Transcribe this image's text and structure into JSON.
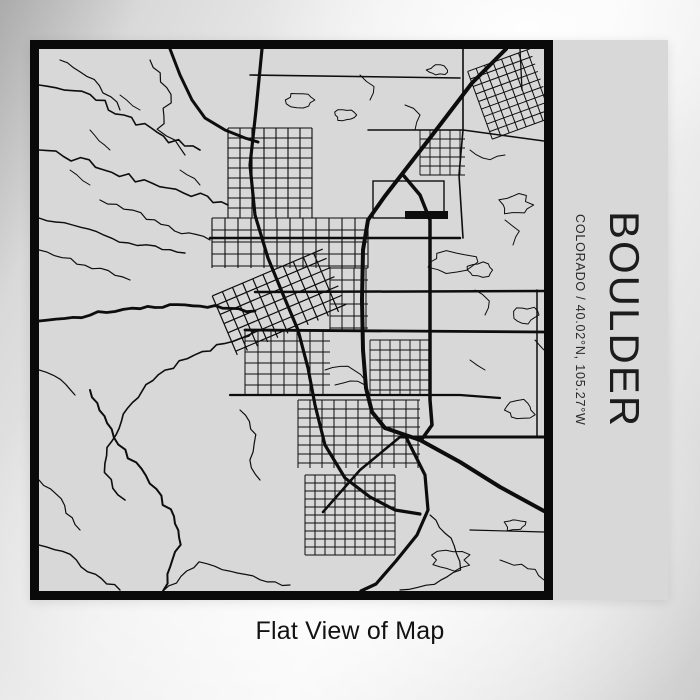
{
  "product": {
    "title": "BOULDER",
    "subtitle": "COLORADO / 40.02°N, 105.27°W",
    "caption": "Flat View of Map"
  },
  "colors": {
    "paper": "#d8d8d8",
    "ink": "#0d0d0d",
    "frame": "#0a0a0a",
    "title_text": "#1c1c1c",
    "caption_text": "#121212"
  },
  "map_art": {
    "viewbox": [
      0,
      0,
      505,
      542
    ],
    "roads": [
      {
        "w": 4,
        "pts": [
          [
            467,
            0
          ],
          [
            433,
            34
          ],
          [
            391,
            89
          ],
          [
            346,
            147
          ],
          [
            329,
            171
          ],
          [
            324,
            201
          ],
          [
            323,
            251
          ],
          [
            324,
            301
          ],
          [
            327,
            339
          ],
          [
            333,
            363
          ],
          [
            346,
            379
          ]
        ]
      },
      {
        "w": 4,
        "pts": [
          [
            346,
            379
          ],
          [
            381,
            391
          ],
          [
            421,
            413
          ],
          [
            461,
            438
          ],
          [
            505,
            462
          ]
        ]
      },
      {
        "w": 3.2,
        "pts": [
          [
            366,
            386
          ],
          [
            386,
            426
          ],
          [
            389,
            461
          ],
          [
            378,
            486
          ],
          [
            357,
            512
          ],
          [
            337,
            535
          ],
          [
            322,
            542
          ]
        ]
      },
      {
        "w": 3.2,
        "pts": [
          [
            223,
            0
          ],
          [
            217,
            61
          ],
          [
            211,
            116
          ],
          [
            216,
            166
          ],
          [
            229,
            209
          ],
          [
            243,
            243
          ],
          [
            259,
            281
          ],
          [
            269,
            319
          ],
          [
            276,
            356
          ],
          [
            286,
            396
          ],
          [
            306,
            429
          ],
          [
            331,
            448
          ],
          [
            356,
            461
          ],
          [
            381,
            465
          ]
        ]
      },
      {
        "w": 2.5,
        "pts": [
          [
            284,
            463
          ],
          [
            321,
            421
          ],
          [
            361,
            388
          ]
        ]
      },
      {
        "w": 3,
        "pts": [
          [
            131,
            0
          ],
          [
            141,
            26
          ],
          [
            153,
            51
          ],
          [
            166,
            69
          ],
          [
            186,
            81
          ],
          [
            206,
            89
          ],
          [
            219,
            93
          ]
        ]
      },
      {
        "w": 3.5,
        "pts": [
          [
            365,
            127
          ],
          [
            381,
            146
          ],
          [
            391,
            171
          ],
          [
            391,
            250
          ],
          [
            391,
            311
          ],
          [
            391,
            351
          ],
          [
            393,
            376
          ],
          [
            383,
            390
          ]
        ]
      },
      {
        "w": 2.8,
        "pts": [
          [
            206,
            281
          ],
          [
            505,
            283
          ]
        ]
      },
      {
        "w": 2.5,
        "pts": [
          [
            216,
            243
          ],
          [
            505,
            242
          ]
        ]
      },
      {
        "w": 2.5,
        "pts": [
          [
            171,
            189
          ],
          [
            421,
            189
          ]
        ]
      },
      {
        "w": 3,
        "pts": [
          [
            361,
            388
          ],
          [
            505,
            388
          ]
        ]
      },
      {
        "w": 2.2,
        "pts": [
          [
            191,
            346
          ],
          [
            421,
            346
          ],
          [
            461,
            349
          ]
        ]
      },
      {
        "w": 2.8,
        "amp": 2.5,
        "seed": 11,
        "pts": [
          [
            0,
            272
          ],
          [
            51,
            266
          ],
          [
            101,
            258
          ],
          [
            146,
            257
          ],
          [
            191,
            259
          ],
          [
            216,
            262
          ]
        ]
      },
      {
        "w": 1.6,
        "amp": 3.5,
        "seed": 12,
        "pts": [
          [
            0,
            101
          ],
          [
            41,
            111
          ],
          [
            81,
            126
          ],
          [
            121,
            136
          ],
          [
            161,
            146
          ],
          [
            189,
            156
          ]
        ]
      },
      {
        "w": 1.4,
        "amp": 3,
        "seed": 13,
        "pts": [
          [
            0,
            169
          ],
          [
            41,
            181
          ],
          [
            81,
            191
          ],
          [
            116,
            199
          ],
          [
            146,
            204
          ]
        ]
      },
      {
        "w": 1.6,
        "amp": 3.5,
        "seed": 14,
        "pts": [
          [
            0,
            36
          ],
          [
            51,
            46
          ],
          [
            91,
            71
          ],
          [
            131,
            91
          ],
          [
            161,
            101
          ]
        ]
      },
      {
        "w": 1.2,
        "amp": 3,
        "seed": 15,
        "pts": [
          [
            21,
            11
          ],
          [
            61,
            36
          ],
          [
            81,
            61
          ]
        ]
      },
      {
        "w": 1.2,
        "amp": 3.5,
        "seed": 16,
        "pts": [
          [
            111,
            11
          ],
          [
            131,
            46
          ],
          [
            121,
            81
          ],
          [
            146,
            106
          ]
        ]
      },
      {
        "w": 1.2,
        "amp": 3,
        "seed": 17,
        "pts": [
          [
            61,
            151
          ],
          [
            101,
            166
          ],
          [
            136,
            181
          ],
          [
            171,
            191
          ]
        ]
      },
      {
        "w": 1.2,
        "amp": 3,
        "seed": 18,
        "pts": [
          [
            0,
            201
          ],
          [
            31,
            211
          ],
          [
            61,
            221
          ],
          [
            91,
            231
          ]
        ]
      },
      {
        "w": 1.6,
        "amp": 3,
        "seed": 19,
        "pts": [
          [
            216,
            281
          ],
          [
            186,
            296
          ],
          [
            156,
            306
          ],
          [
            126,
            321
          ],
          [
            101,
            341
          ],
          [
            86,
            366
          ],
          [
            71,
            391
          ],
          [
            64,
            414
          ],
          [
            71,
            431
          ],
          [
            86,
            451
          ]
        ]
      },
      {
        "w": 2,
        "amp": 3,
        "seed": 20,
        "pts": [
          [
            51,
            341
          ],
          [
            71,
            381
          ],
          [
            101,
            421
          ],
          [
            131,
            461
          ],
          [
            141,
            496
          ],
          [
            131,
            526
          ],
          [
            124,
            542
          ]
        ]
      },
      {
        "w": 1.4,
        "amp": 3,
        "seed": 21,
        "pts": [
          [
            0,
            496
          ],
          [
            31,
            506
          ],
          [
            56,
            526
          ],
          [
            81,
            541
          ]
        ]
      },
      {
        "w": 1.2,
        "amp": 3,
        "seed": 22,
        "pts": [
          [
            0,
            431
          ],
          [
            21,
            451
          ],
          [
            41,
            481
          ]
        ]
      },
      {
        "w": 1.2,
        "amp": 2.5,
        "seed": 23,
        "pts": [
          [
            201,
            361
          ],
          [
            216,
            386
          ],
          [
            211,
            411
          ],
          [
            221,
            431
          ]
        ]
      },
      {
        "w": 1.2,
        "amp": 2,
        "seed": 24,
        "pts": [
          [
            124,
            542
          ],
          [
            161,
            514
          ],
          [
            191,
            521
          ],
          [
            221,
            531
          ],
          [
            251,
            536
          ]
        ]
      },
      {
        "w": 1,
        "amp": 2,
        "seed": 25,
        "pts": [
          [
            51,
            81
          ],
          [
            71,
            101
          ]
        ]
      },
      {
        "w": 1,
        "amp": 2,
        "seed": 26,
        "pts": [
          [
            81,
            46
          ],
          [
            101,
            61
          ]
        ]
      },
      {
        "w": 1,
        "amp": 2,
        "seed": 27,
        "pts": [
          [
            141,
            121
          ],
          [
            161,
            136
          ]
        ]
      },
      {
        "w": 1,
        "amp": 2,
        "seed": 28,
        "pts": [
          [
            31,
            121
          ],
          [
            51,
            136
          ]
        ]
      },
      {
        "w": 1.2,
        "amp": 2,
        "seed": 29,
        "pts": [
          [
            0,
            321
          ],
          [
            21,
            331
          ],
          [
            36,
            346
          ]
        ]
      },
      {
        "w": 1.6,
        "pts": [
          [
            211,
            26
          ],
          [
            421,
            29
          ]
        ]
      },
      {
        "w": 1.6,
        "pts": [
          [
            424,
            0
          ],
          [
            424,
            81
          ],
          [
            420,
            126
          ],
          [
            424,
            189
          ]
        ]
      },
      {
        "w": 1.3,
        "pts": [
          [
            481,
            0
          ],
          [
            483,
            41
          ]
        ]
      },
      {
        "w": 1.5,
        "pts": [
          [
            329,
            81
          ],
          [
            424,
            81
          ],
          [
            505,
            92
          ]
        ]
      },
      {
        "w": 1,
        "amp": 2,
        "seed": 30,
        "pts": [
          [
            431,
            101
          ],
          [
            451,
            111
          ],
          [
            466,
            106
          ]
        ]
      },
      {
        "w": 1,
        "amp": 2,
        "seed": 31,
        "pts": [
          [
            466,
            171
          ],
          [
            481,
            181
          ],
          [
            474,
            196
          ]
        ]
      },
      {
        "w": 1,
        "amp": 2,
        "seed": 32,
        "pts": [
          [
            436,
            241
          ],
          [
            451,
            251
          ],
          [
            446,
            266
          ]
        ]
      },
      {
        "w": 1,
        "amp": 1.5,
        "seed": 33,
        "pts": [
          [
            496,
            291
          ],
          [
            505,
            301
          ]
        ]
      },
      {
        "w": 1,
        "amp": 1.5,
        "seed": 34,
        "pts": [
          [
            431,
            311
          ],
          [
            446,
            321
          ]
        ]
      },
      {
        "w": 1,
        "amp": 2,
        "seed": 35,
        "pts": [
          [
            366,
            56
          ],
          [
            381,
            66
          ],
          [
            376,
            81
          ]
        ]
      },
      {
        "w": 1,
        "amp": 2,
        "seed": 36,
        "pts": [
          [
            321,
            26
          ],
          [
            336,
            36
          ],
          [
            331,
            51
          ]
        ]
      },
      {
        "w": 1.5,
        "pts": [
          [
            498,
            241
          ],
          [
            498,
            388
          ]
        ]
      },
      {
        "w": 1.2,
        "pts": [
          [
            431,
            481
          ],
          [
            505,
            483
          ]
        ]
      },
      {
        "w": 1,
        "amp": 1.5,
        "seed": 37,
        "pts": [
          [
            286,
            321
          ],
          [
            301,
            316
          ],
          [
            316,
            321
          ],
          [
            326,
            331
          ]
        ]
      },
      {
        "w": 1,
        "amp": 1.5,
        "seed": 38,
        "pts": [
          [
            296,
            336
          ],
          [
            311,
            331
          ],
          [
            326,
            336
          ]
        ]
      },
      {
        "w": 1.2,
        "amp": 1.5,
        "seed": 39,
        "pts": [
          [
            391,
            466
          ],
          [
            416,
            496
          ],
          [
            421,
            521
          ],
          [
            396,
            536
          ],
          [
            361,
            541
          ]
        ]
      },
      {
        "w": 1,
        "amp": 2,
        "seed": 40,
        "pts": [
          [
            461,
            511
          ],
          [
            496,
            521
          ],
          [
            505,
            531
          ]
        ]
      }
    ],
    "grids": [
      {
        "x": 189,
        "y": 79,
        "w": 84,
        "h": 90,
        "dx": 12,
        "dy": 10,
        "lw": 1.1
      },
      {
        "x": 173,
        "y": 169,
        "w": 156,
        "h": 50,
        "dx": 13,
        "dy": 12,
        "lw": 1.1
      },
      {
        "x": 291,
        "y": 219,
        "w": 38,
        "h": 62,
        "dx": 12,
        "dy": 12,
        "lw": 1
      },
      {
        "x": 206,
        "y": 281,
        "w": 85,
        "h": 65,
        "dx": 13,
        "dy": 11,
        "lw": 1
      },
      {
        "x": 259,
        "y": 351,
        "w": 122,
        "h": 68,
        "dx": 12,
        "dy": 9,
        "lw": 1
      },
      {
        "x": 266,
        "y": 426,
        "w": 90,
        "h": 80,
        "dx": 10,
        "dy": 8,
        "lw": 1
      },
      {
        "x": 331,
        "y": 291,
        "w": 60,
        "h": 55,
        "dx": 10,
        "dy": 10,
        "lw": 0.9
      },
      {
        "x": 439,
        "y": 9,
        "w": 66,
        "h": 72,
        "dx": 9,
        "dy": 8,
        "lw": 1,
        "rot": -20
      },
      {
        "x": 381,
        "y": 81,
        "w": 45,
        "h": 45,
        "dx": 10,
        "dy": 9,
        "lw": 0.9
      },
      {
        "x": 181,
        "y": 221,
        "w": 120,
        "h": 64,
        "dx": 11,
        "dy": 10,
        "lw": 1.2,
        "rot": -23
      }
    ],
    "blobs": [
      {
        "cx": 413,
        "cy": 213,
        "rx": 22,
        "ry": 10,
        "seed": 41
      },
      {
        "cx": 441,
        "cy": 221,
        "rx": 12,
        "ry": 7,
        "seed": 42
      },
      {
        "cx": 476,
        "cy": 156,
        "rx": 15,
        "ry": 10,
        "seed": 43
      },
      {
        "cx": 486,
        "cy": 266,
        "rx": 12,
        "ry": 8,
        "seed": 44
      },
      {
        "cx": 481,
        "cy": 361,
        "rx": 14,
        "ry": 9,
        "seed": 45
      },
      {
        "cx": 411,
        "cy": 511,
        "rx": 18,
        "ry": 10,
        "seed": 46
      },
      {
        "cx": 261,
        "cy": 51,
        "rx": 14,
        "ry": 8,
        "seed": 47
      },
      {
        "cx": 306,
        "cy": 66,
        "rx": 10,
        "ry": 6,
        "seed": 48
      },
      {
        "cx": 399,
        "cy": 21,
        "rx": 10,
        "ry": 5,
        "seed": 49
      },
      {
        "cx": 476,
        "cy": 476,
        "rx": 10,
        "ry": 6,
        "seed": 50
      }
    ],
    "rects": [
      {
        "x": 366,
        "y": 162,
        "w": 43,
        "h": 8,
        "fill": true
      },
      {
        "x": 334,
        "y": 132,
        "w": 71,
        "h": 37,
        "fill": false
      }
    ]
  }
}
